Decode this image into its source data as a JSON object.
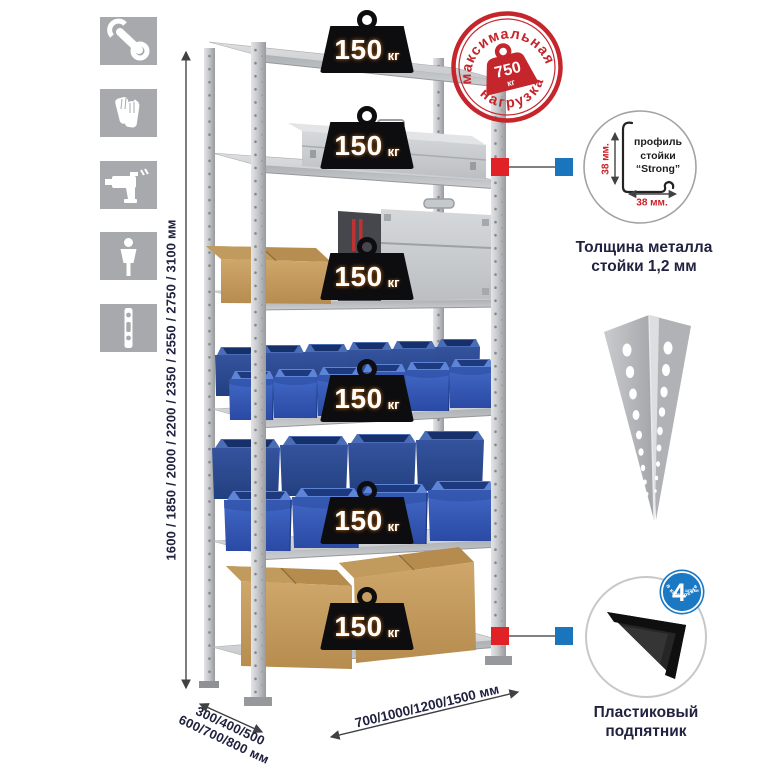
{
  "left_toolbar": {
    "icons": [
      {
        "name": "wrench"
      },
      {
        "name": "gloves"
      },
      {
        "name": "drill"
      },
      {
        "name": "person"
      },
      {
        "name": "level"
      }
    ]
  },
  "dimensions": {
    "height": "1600 / 1850 / 2000 / 2200 / 2350 / 2550 / 2750 / 3100 мм",
    "depth_line1": "300/400/500",
    "depth_line2": "600/700/800 мм",
    "width": "700/1000/1200/1500 мм"
  },
  "shelving": {
    "shelf_count": 6,
    "load_unit": "кг",
    "shelf_loads": [
      "150",
      "150",
      "150",
      "150",
      "150",
      "150"
    ]
  },
  "max_load_stamp": {
    "arc_top": "максимальная",
    "arc_bottom": "нагрузка",
    "value": "750",
    "unit": "кг"
  },
  "profile_detail": {
    "line1": "профиль",
    "line2": "стойки",
    "line3": "“Strong”",
    "dim_vertical": "38 мм.",
    "dim_horizontal": "38 мм.",
    "caption1": "Толщина металла",
    "caption2": "стойки 1,2 мм"
  },
  "foot_detail": {
    "badge_value": "4",
    "badge_word": "штуки",
    "badge_arc": "в комплекте",
    "caption1": "Пластиковый",
    "caption2": "подпятник"
  },
  "colors": {
    "accent_red": "#c5262c",
    "marker_red": "#e02227",
    "marker_blue": "#1b75bc",
    "bin_blue": "#3a62bd",
    "metal_gray": "#c2c4c7",
    "icon_gray": "#a7a9ac",
    "text_navy": "#20223f"
  }
}
